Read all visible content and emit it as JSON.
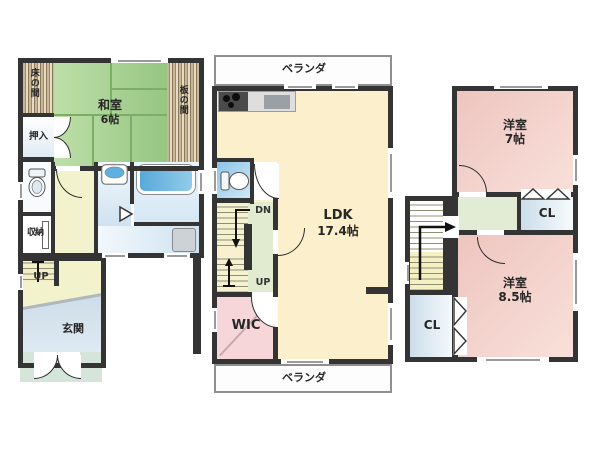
{
  "floor1": {
    "tokonoma": "床の間",
    "oshiire": "押入",
    "washitsu_name": "和室",
    "washitsu_size": "6帖",
    "itanoma": "板の間",
    "shunou": "収納",
    "stairs_up": "UP",
    "genkan": "玄関"
  },
  "floor2": {
    "veranda_top": "ベランダ",
    "stairs_down": "DN",
    "stairs_up": "UP",
    "ldk_name": "LDK",
    "ldk_size": "17.4帖",
    "wic": "WIC",
    "veranda_bottom": "ベランダ"
  },
  "floor3": {
    "western7_name": "洋室",
    "western7_size": "7帖",
    "closet_top": "CL",
    "western85_name": "洋室",
    "western85_size": "8.5帖",
    "closet_bottom": "CL"
  },
  "colors": {
    "wall": "#343434",
    "tatami_green": "#a9d295",
    "ldk_cream": "#fbf0cb",
    "western_pink": "#f0c9c3",
    "wic_pink": "#f7d6da",
    "stair_cream": "#f5f0c2",
    "landing_green": "#e0ebd0",
    "wet_blue": "#cfe2f0",
    "genkan_blue": "#c2d5e2",
    "porch_green": "#d5e5d9",
    "tub_blue": "#57a9da"
  }
}
